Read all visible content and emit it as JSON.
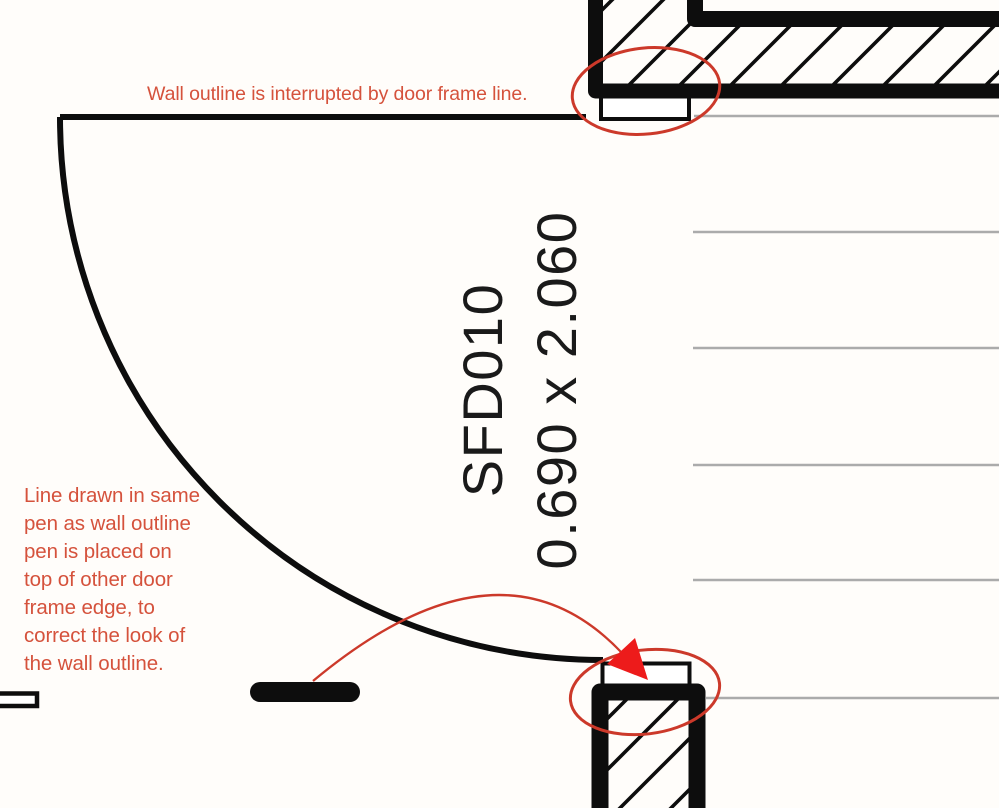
{
  "door": {
    "label": "SFD010",
    "size": "0.690 x 2.060"
  },
  "annotations": {
    "top_note": "Wall outline is interrupted by door frame line.",
    "left_note_lines": [
      "Line drawn in same",
      "pen as wall outline",
      "pen is placed on",
      "top of other door",
      "frame edge, to",
      "correct the look of",
      "the wall outline."
    ]
  },
  "colors": {
    "background": "#fffdfa",
    "ink_black": "#0d0d0d",
    "guide_gray": "#ababab",
    "annotation_text": "#d5523c",
    "highlight_red": "#cc392a",
    "arrow_red": "#ed1b1b"
  }
}
